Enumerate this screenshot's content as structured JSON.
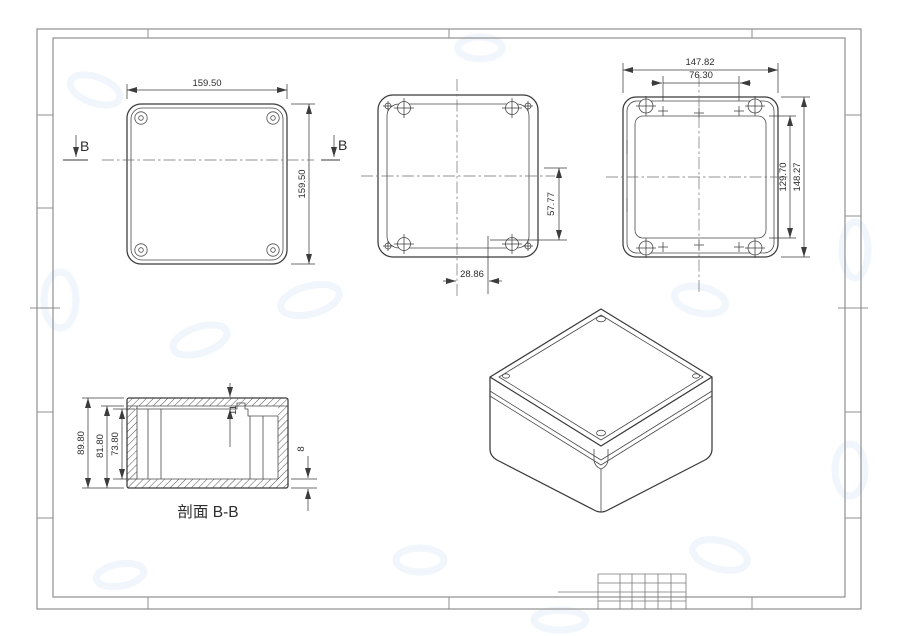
{
  "sheet": {
    "section_label": "剖面 B-B",
    "cut_marker_left": "B",
    "cut_marker_right": "B"
  },
  "views": {
    "lid_outside": {
      "width": "159.50",
      "height": "159.50"
    },
    "base_open": {
      "half_height": "57.77",
      "half_width": "28.86"
    },
    "lid_inside": {
      "outer_width": "147.82",
      "hole_spacing": "76.30",
      "inner_height": "129.70",
      "outer_height": "148.27"
    },
    "section_bb": {
      "overall_height": "89.80",
      "base_height": "81.80",
      "cavity_depth": "73.80",
      "lid_height": "11",
      "wall_thickness": "8"
    }
  },
  "colors": {
    "line": "#3a3a3a",
    "frame": "#8f8f8f",
    "centerline": "#6e6e6e",
    "watermark": "#e4eef7"
  }
}
